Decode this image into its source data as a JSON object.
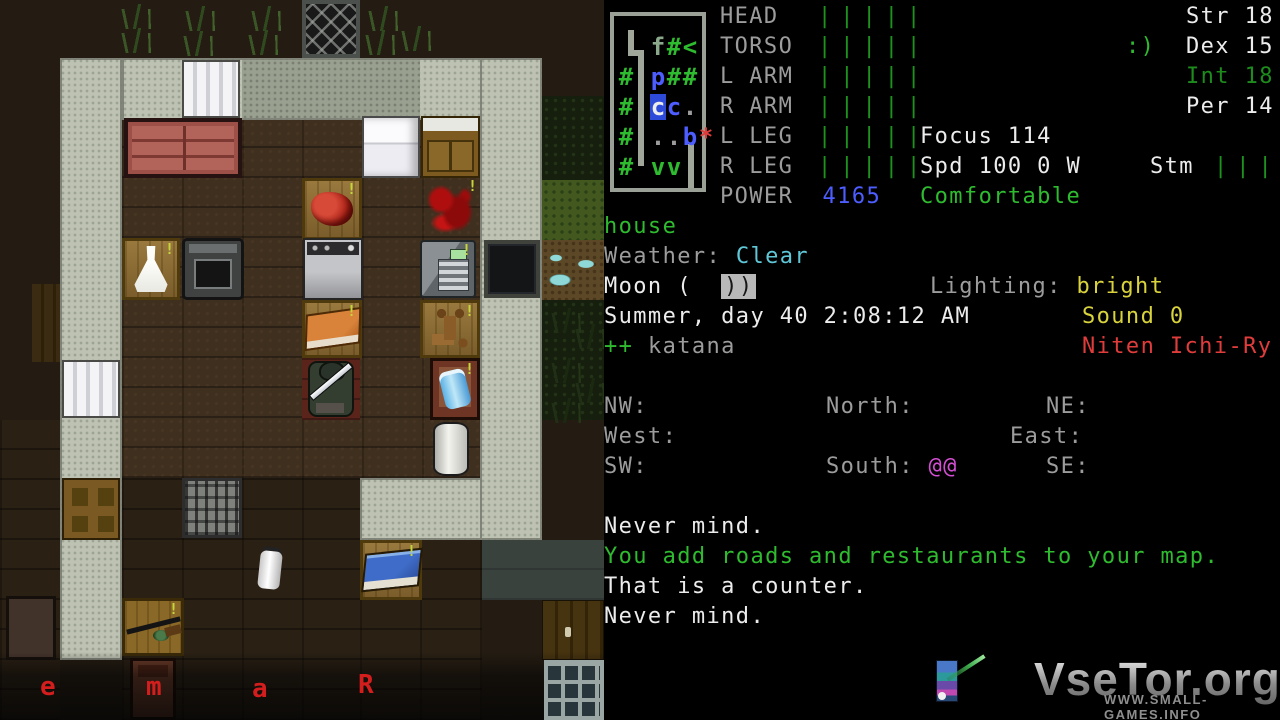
{
  "panel": {
    "minimap": {
      "rows": [
        [
          {
            "t": "f",
            "c": "c-fgn",
            "col": 2
          },
          {
            "t": "#",
            "c": "c-gn",
            "col": 3
          },
          {
            "t": "<",
            "c": "c-gn",
            "col": 4
          }
        ],
        [
          {
            "t": "#",
            "c": "c-gn",
            "col": 0
          },
          {
            "t": "p",
            "c": "c-bl",
            "col": 2
          },
          {
            "t": "#",
            "c": "c-gn",
            "col": 3
          },
          {
            "t": "#",
            "c": "c-gn",
            "col": 4
          }
        ],
        [
          {
            "t": "#",
            "c": "c-gn",
            "col": 0
          },
          {
            "t": "c",
            "c": "c-wh",
            "col": 2,
            "bg": "#2e4ad8"
          },
          {
            "t": "c",
            "c": "c-bl",
            "col": 3
          },
          {
            "t": ".",
            "c": "c-gy",
            "col": 4
          }
        ],
        [
          {
            "t": "#",
            "c": "c-gn",
            "col": 0
          },
          {
            "t": ".",
            "c": "c-gy",
            "col": 2
          },
          {
            "t": ".",
            "c": "c-gy",
            "col": 3
          },
          {
            "t": "b",
            "c": "c-bl",
            "col": 4
          },
          {
            "t": "*",
            "c": "c-rd",
            "col": 5
          }
        ],
        [
          {
            "t": "#",
            "c": "c-gn",
            "col": 0
          },
          {
            "t": "v",
            "c": "c-gn",
            "col": 2
          },
          {
            "t": "v",
            "c": "c-gn",
            "col": 3
          }
        ]
      ]
    },
    "body_status": {
      "rows": [
        {
          "label": "HEAD",
          "bars": "|||||"
        },
        {
          "label": "TORSO",
          "bars": "|||||"
        },
        {
          "label": "L ARM",
          "bars": "|||||"
        },
        {
          "label": "R ARM",
          "bars": "|||||"
        },
        {
          "label": "L LEG",
          "bars": "|||||"
        },
        {
          "label": "R LEG",
          "bars": "|||||"
        }
      ],
      "power_label": "POWER",
      "power_value": "4165"
    },
    "stats": {
      "str": "Str 18",
      "dex": "Dex 15",
      "int": "Int 18",
      "per": "Per 14",
      "mood": ":)"
    },
    "status": {
      "focus": "Focus 114",
      "speed": "Spd 100 0 W",
      "stm_label": "Stm",
      "stm_bars": "|||||",
      "comfort": "Comfortable"
    },
    "location": {
      "place": "house",
      "weather_label": "Weather:",
      "weather_value": "Clear",
      "moon_label": "Moon (",
      "moon_phase": "))",
      "lighting_label": "Lighting:",
      "lighting_value": "bright",
      "date": "Summer, day 40 2:08:12 AM",
      "sound": "Sound 0",
      "wield_plus": "++",
      "wield": "katana",
      "style": "Niten Ichi-Ry"
    },
    "compass": {
      "nw": "NW:",
      "north": "North:",
      "ne": "NE:",
      "west": "West:",
      "east": "East:",
      "sw": "SW:",
      "south": "South:",
      "south_val": "@@",
      "se": "SE:"
    },
    "messages": [
      {
        "text": "Never mind.",
        "c": "c-wh"
      },
      {
        "text": "You add roads and restaurants to your map.",
        "c": "c-gn"
      },
      {
        "text": "That is a counter.",
        "c": "c-wh"
      },
      {
        "text": "Never mind.",
        "c": "c-wh"
      }
    ],
    "watermark": {
      "title": "VseTor.org",
      "subtitle": "WWW.SMALL-GAMES.INFO"
    }
  },
  "map": {
    "tiles": [
      {
        "tp": "floor",
        "x": 122,
        "y": 120,
        "w": 358,
        "h": 358,
        "it": false
      },
      {
        "tp": "floor-dim",
        "x": 122,
        "y": 478,
        "w": 238,
        "h": 242,
        "it": false
      },
      {
        "tp": "floor-dim",
        "x": 360,
        "y": 540,
        "w": 122,
        "h": 180,
        "it": false
      },
      {
        "tp": "floor-dim",
        "x": 0,
        "y": 420,
        "w": 60,
        "h": 300,
        "it": false
      },
      {
        "tp": "floor-shadow",
        "x": 482,
        "y": 540,
        "w": 122,
        "h": 60,
        "it": false
      },
      {
        "tp": "grass-dark",
        "x": 542,
        "y": 96,
        "w": 62,
        "h": 84,
        "it": false
      },
      {
        "tp": "grass",
        "x": 542,
        "y": 180,
        "w": 62,
        "h": 60,
        "it": false
      },
      {
        "tp": "water-dirt",
        "x": 542,
        "y": 240,
        "w": 62,
        "h": 60,
        "it": false
      },
      {
        "tp": "grass-dark",
        "x": 542,
        "y": 300,
        "w": 62,
        "h": 120,
        "it": false
      },
      {
        "tp": "fence",
        "x": 302,
        "y": 0,
        "w": 58,
        "h": 58,
        "it": true
      },
      {
        "tp": "door-wood-dark",
        "x": 32,
        "y": 284,
        "w": 30,
        "h": 78,
        "it": true
      },
      {
        "tp": "wall",
        "x": 60,
        "y": 58,
        "w": 62,
        "h": 602,
        "it": false
      },
      {
        "tp": "wall",
        "x": 122,
        "y": 58,
        "w": 360,
        "h": 62,
        "it": false
      },
      {
        "tp": "wall-dim",
        "x": 242,
        "y": 60,
        "w": 178,
        "h": 58,
        "it": false
      },
      {
        "tp": "wall",
        "x": 480,
        "y": 58,
        "w": 62,
        "h": 482,
        "it": false
      },
      {
        "tp": "wall",
        "x": 360,
        "y": 478,
        "w": 122,
        "h": 62,
        "it": false
      },
      {
        "tp": "door-white",
        "x": 182,
        "y": 60,
        "w": 58,
        "h": 58,
        "it": true
      },
      {
        "tp": "door-white",
        "x": 62,
        "y": 360,
        "w": 58,
        "h": 58,
        "it": true
      },
      {
        "tp": "door-wood",
        "x": 62,
        "y": 478,
        "w": 58,
        "h": 62,
        "it": true
      },
      {
        "tp": "window-dark",
        "x": 484,
        "y": 240,
        "w": 56,
        "h": 58,
        "it": true
      },
      {
        "tp": "couch",
        "x": 124,
        "y": 118,
        "w": 118,
        "h": 60,
        "it": true
      },
      {
        "tp": "fridge",
        "x": 362,
        "y": 116,
        "w": 58,
        "h": 62,
        "it": true
      },
      {
        "tp": "cabinet",
        "x": 421,
        "y": 116,
        "w": 59,
        "h": 62,
        "it": true
      },
      {
        "tp": "counter",
        "x": 302,
        "y": 178,
        "w": 60,
        "h": 62,
        "it": true,
        "item": "meat",
        "mk": true
      },
      {
        "tp": "blood",
        "x": 420,
        "y": 178,
        "w": 60,
        "h": 62,
        "it": true,
        "mk": true
      },
      {
        "tp": "counter",
        "x": 122,
        "y": 238,
        "w": 58,
        "h": 62,
        "it": true,
        "item": "flask",
        "mk": true
      },
      {
        "tp": "stove",
        "x": 182,
        "y": 238,
        "w": 62,
        "h": 62,
        "it": true
      },
      {
        "tp": "washer",
        "x": 303,
        "y": 238,
        "w": 60,
        "h": 62,
        "it": true
      },
      {
        "tp": "safe",
        "x": 420,
        "y": 240,
        "w": 56,
        "h": 58,
        "it": true,
        "mk": true
      },
      {
        "tp": "counter",
        "x": 302,
        "y": 300,
        "w": 60,
        "h": 58,
        "it": true,
        "item": "book-orange",
        "mk": true
      },
      {
        "tp": "counter",
        "x": 420,
        "y": 300,
        "w": 60,
        "h": 58,
        "it": true,
        "item": "faucet",
        "mk": true
      },
      {
        "tp": "maroon",
        "x": 302,
        "y": 358,
        "w": 58,
        "h": 62,
        "it": false,
        "player": true
      },
      {
        "tp": "chair",
        "x": 430,
        "y": 358,
        "w": 50,
        "h": 62,
        "it": true,
        "item": "bottle-blue",
        "mk": true
      },
      {
        "tp": "plain",
        "x": 422,
        "y": 420,
        "w": 58,
        "h": 58,
        "it": true,
        "item": "cylinder"
      },
      {
        "tp": "grate",
        "x": 182,
        "y": 478,
        "w": 60,
        "h": 60,
        "it": true
      },
      {
        "tp": "counter",
        "x": 360,
        "y": 540,
        "w": 62,
        "h": 60,
        "it": true,
        "item": "book-blue",
        "mk": true
      },
      {
        "tp": "plain",
        "x": 240,
        "y": 540,
        "w": 60,
        "h": 60,
        "it": true,
        "item": "extinguisher"
      },
      {
        "tp": "table",
        "x": 122,
        "y": 598,
        "w": 62,
        "h": 58,
        "it": true,
        "item": "rifle",
        "mk": true
      },
      {
        "tp": "chair2",
        "x": 130,
        "y": 658,
        "w": 46,
        "h": 62,
        "it": true
      },
      {
        "tp": "chair-dark",
        "x": 6,
        "y": 596,
        "w": 50,
        "h": 64,
        "it": true
      },
      {
        "tp": "door-planks",
        "x": 542,
        "y": 600,
        "w": 62,
        "h": 60,
        "it": true
      },
      {
        "tp": "shade",
        "x": 0,
        "y": 652,
        "w": 604,
        "h": 68,
        "it": false
      },
      {
        "tp": "window-glass",
        "x": 544,
        "y": 660,
        "w": 60,
        "h": 60,
        "it": true
      }
    ],
    "tufts": [
      {
        "x": 118,
        "y": 4
      },
      {
        "x": 182,
        "y": 6
      },
      {
        "x": 248,
        "y": 6
      },
      {
        "x": 118,
        "y": 28
      },
      {
        "x": 180,
        "y": 31
      },
      {
        "x": 245,
        "y": 30
      },
      {
        "x": 365,
        "y": 6
      },
      {
        "x": 362,
        "y": 30
      },
      {
        "x": 398,
        "y": 26
      },
      {
        "x": 548,
        "y": 308,
        "dk": true
      },
      {
        "x": 572,
        "y": 324,
        "dk": true
      },
      {
        "x": 548,
        "y": 358,
        "dk": true
      },
      {
        "x": 572,
        "y": 378,
        "dk": true
      },
      {
        "x": 548,
        "y": 398,
        "dk": true
      }
    ],
    "letters": [
      {
        "ch": "e",
        "x": 40,
        "y": 674
      },
      {
        "ch": "m",
        "x": 146,
        "y": 674
      },
      {
        "ch": "a",
        "x": 252,
        "y": 676
      },
      {
        "ch": "R",
        "x": 358,
        "y": 672
      }
    ]
  }
}
